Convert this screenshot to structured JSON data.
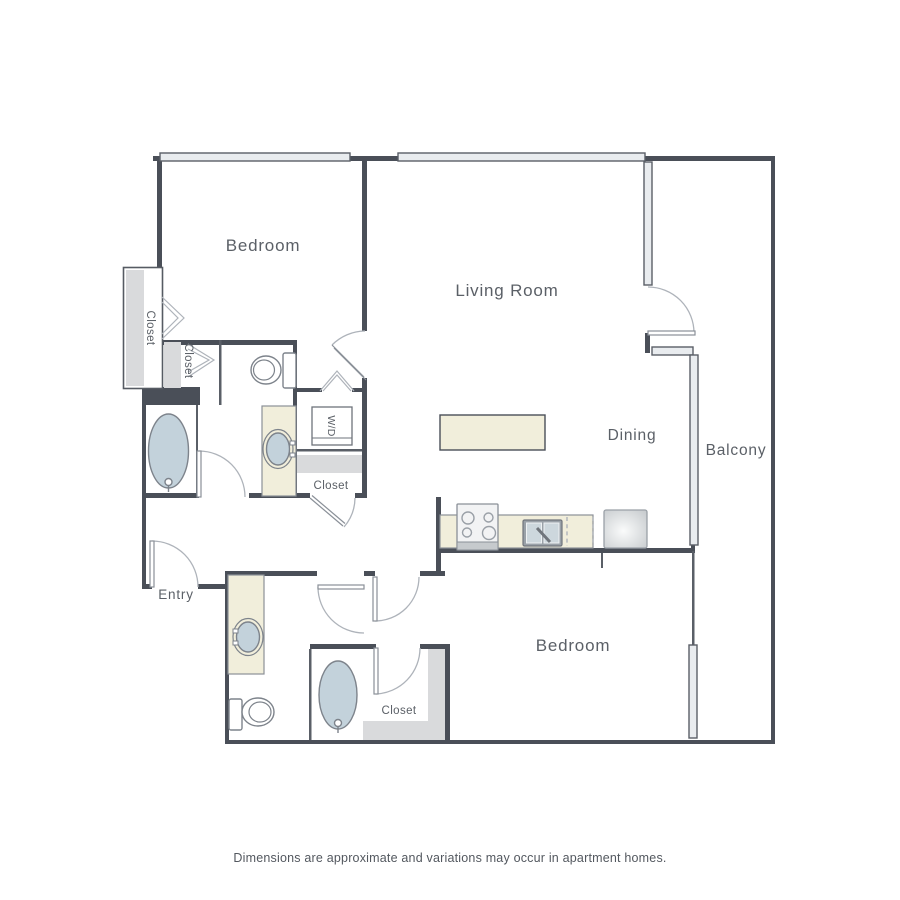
{
  "floor_plan": {
    "labels": {
      "bedroom_top": "Bedroom",
      "living_room": "Living Room",
      "dining": "Dining",
      "balcony": "Balcony",
      "entry": "Entry",
      "bedroom_bottom": "Bedroom",
      "closet_left": "Closet",
      "closet_inner": "Closet",
      "closet_hall": "Closet",
      "washer_dryer": "W/D",
      "closet_bedroom2": "Closet"
    },
    "disclaimer": "Dimensions are approximate and variations may occur in apartment homes.",
    "colors": {
      "bg": "#ffffff",
      "wall": "#4a4f58",
      "thin_line": "#5a5f67",
      "window_fill": "#e9ecef",
      "beige": "#f1eedb",
      "beige_stroke": "#8b9097",
      "fixture_fill": "#c3d2db",
      "fixture_stroke": "#7d838b",
      "shelf": "#d9dadc",
      "arc": "#aeb3ba",
      "leaf": "#8a9098",
      "text": "#5b6067"
    }
  }
}
